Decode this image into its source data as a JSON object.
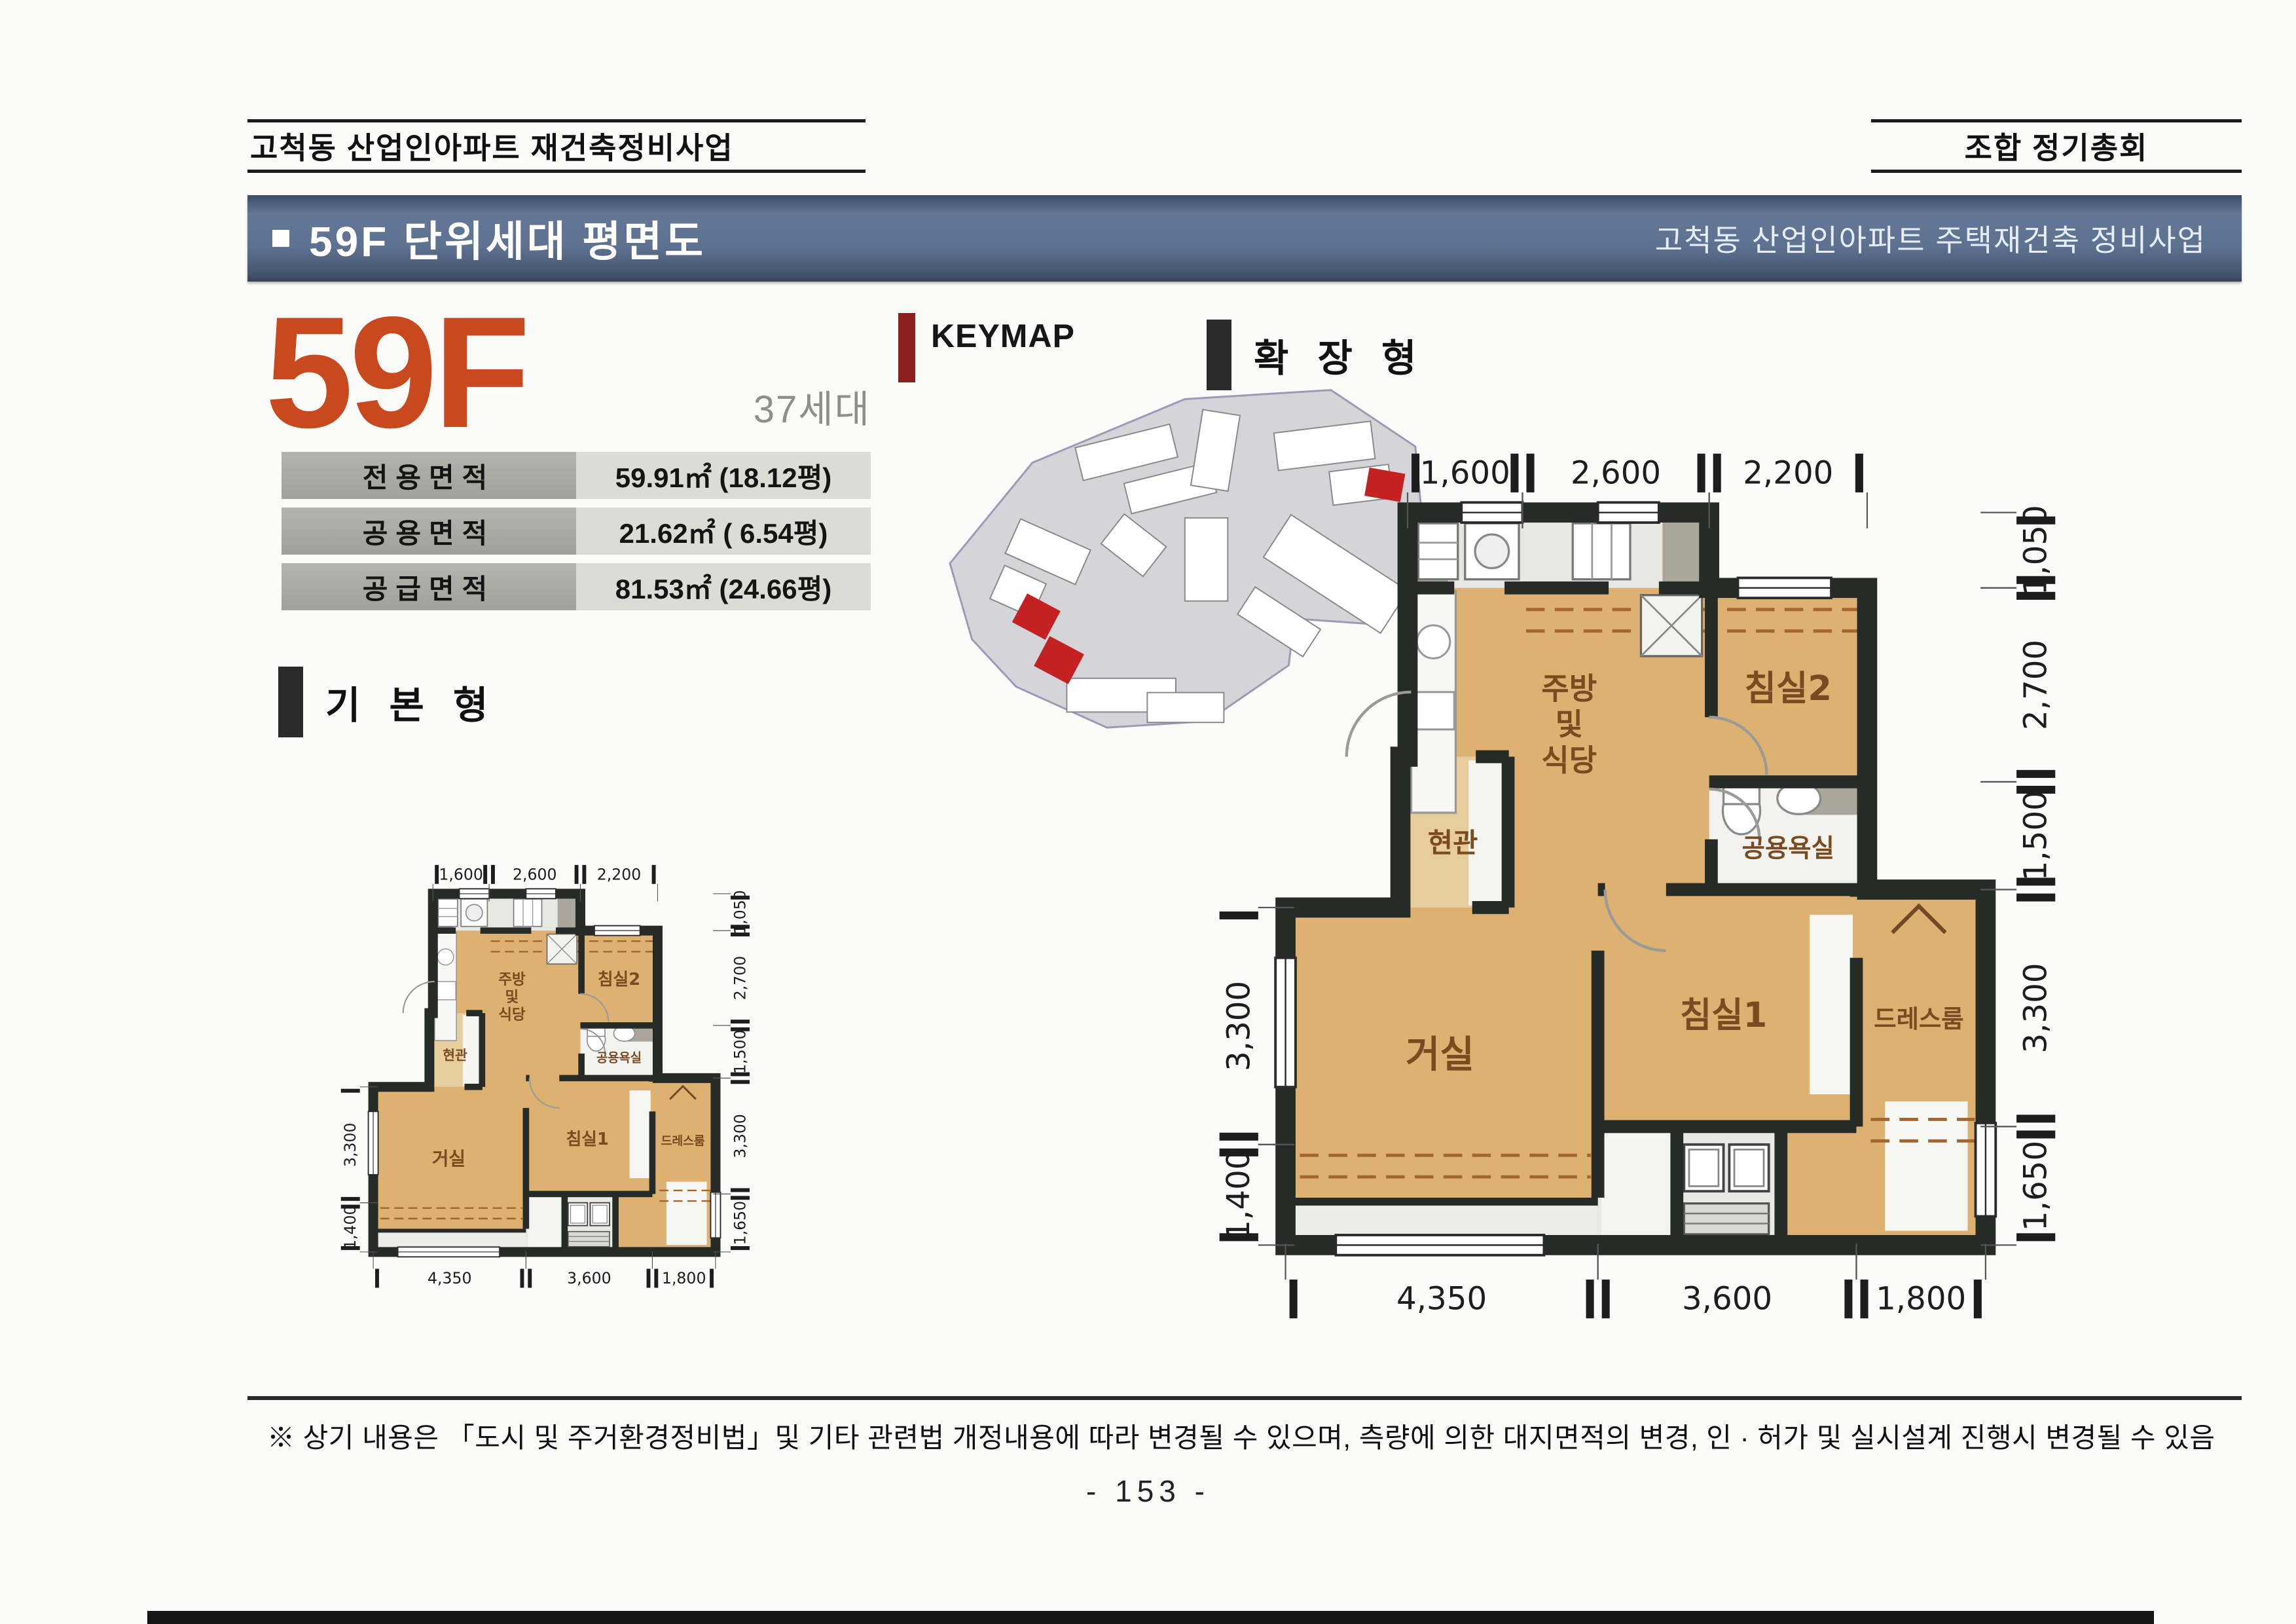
{
  "header": {
    "left": "고척동 산업인아파트 재건축정비사업",
    "right": "조합 정기총회"
  },
  "title_bar": {
    "title": "59F 단위세대 평면도",
    "subtitle": "고척동 산업인아파트 주택재건축 정비사업"
  },
  "unit": {
    "code": "59F",
    "count": "37세대"
  },
  "area_table": {
    "rows": [
      {
        "label": "전용면적",
        "value": "59.91㎡ (18.12평)"
      },
      {
        "label": "공용면적",
        "value": "21.62㎡ ( 6.54평)"
      },
      {
        "label": "공급면적",
        "value": "81.53㎡ (24.66평)"
      }
    ]
  },
  "keymap": {
    "label": "KEYMAP"
  },
  "plan_types": {
    "expanded": "확 장 형",
    "basic": "기 본 형"
  },
  "plan": {
    "rooms": {
      "kitchen": [
        "주방",
        "및",
        "식당"
      ],
      "bedroom2": "침실2",
      "entrance": "현관",
      "bath": "공용욕실",
      "living": "거실",
      "bedroom1": "침실1",
      "dressroom": "드레스룸"
    },
    "dims": {
      "top": [
        {
          "label": "1,600",
          "from": 1700,
          "to": 3300
        },
        {
          "label": "2,600",
          "from": 3300,
          "to": 5900
        },
        {
          "label": "2,200",
          "from": 5900,
          "to": 8100
        }
      ],
      "right": [
        {
          "label": "1,050",
          "from": 0,
          "to": 1050
        },
        {
          "label": "2,700",
          "from": 1050,
          "to": 3750
        },
        {
          "label": "1,500",
          "from": 3750,
          "to": 5250
        },
        {
          "label": "3,300",
          "from": 5250,
          "to": 8550
        },
        {
          "label": "1,650",
          "from": 8550,
          "to": 10200
        }
      ],
      "left": [
        {
          "label": "3,300",
          "from": 5500,
          "to": 8800
        },
        {
          "label": "1,400",
          "from": 8800,
          "to": 10200
        }
      ],
      "bottom": [
        {
          "label": "4,350",
          "from": 0,
          "to": 4350
        },
        {
          "label": "3,600",
          "from": 4350,
          "to": 7950
        },
        {
          "label": "1,800",
          "from": 7950,
          "to": 9750
        }
      ]
    }
  },
  "footer": {
    "note": "※ 상기 내용은 「도시 및 주거환경정비법」및 기타 관련법 개정내용에 따라 변경될 수 있으며, 측량에 의한 대지면적의 변경, 인 · 허가 및 실시설계 진행시 변경될 수 있음",
    "page": "- 153 -"
  },
  "colors": {
    "accent_orange": "#c9491f",
    "title_bar_blue": "#5d7190",
    "keymap_red": "#8e1f1f",
    "wall_dark": "#262b27",
    "floor_tan": "#dcb172",
    "room_label_brown": "#7a4a20"
  }
}
